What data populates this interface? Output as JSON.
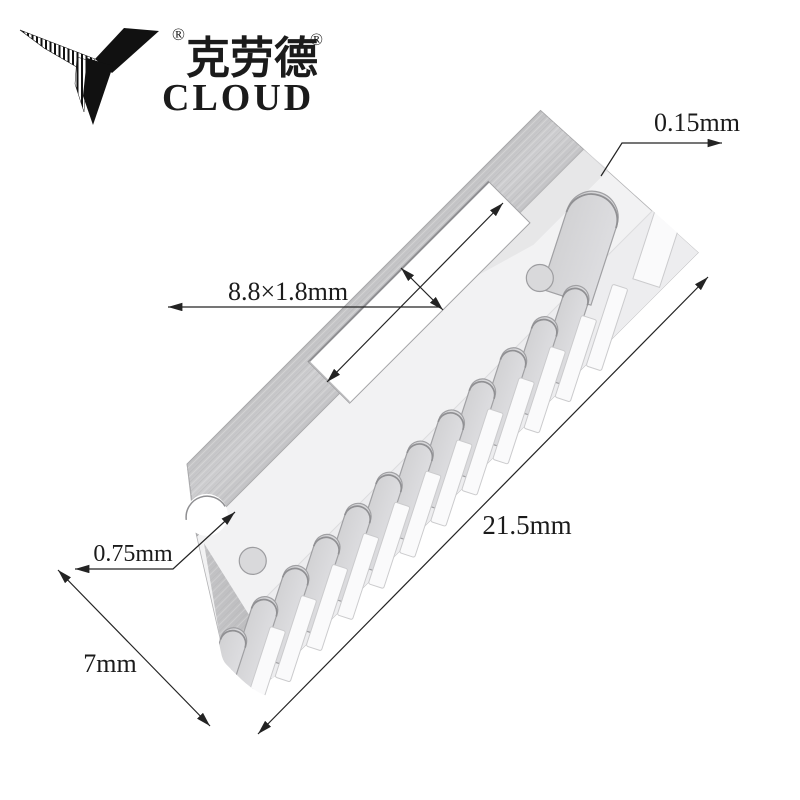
{
  "brand": {
    "name_cn": "克劳德",
    "name_en": "CLOUD",
    "registered": "®"
  },
  "dims": {
    "thickness": "0.15mm",
    "slot": "8.8×1.8mm",
    "length": "21.5mm",
    "notch": "0.75mm",
    "width": "7mm"
  },
  "part": {
    "small_tooth_slots": 12,
    "large_tooth_slots": 1,
    "holes": 2,
    "rect_slot": 1
  },
  "colors": {
    "band": "#c9c9cb",
    "face": "#f2f2f3",
    "flap": "#ededef",
    "slot_fill": "#d6d6d8",
    "dim_line": "#232323",
    "logo": "#111111"
  }
}
